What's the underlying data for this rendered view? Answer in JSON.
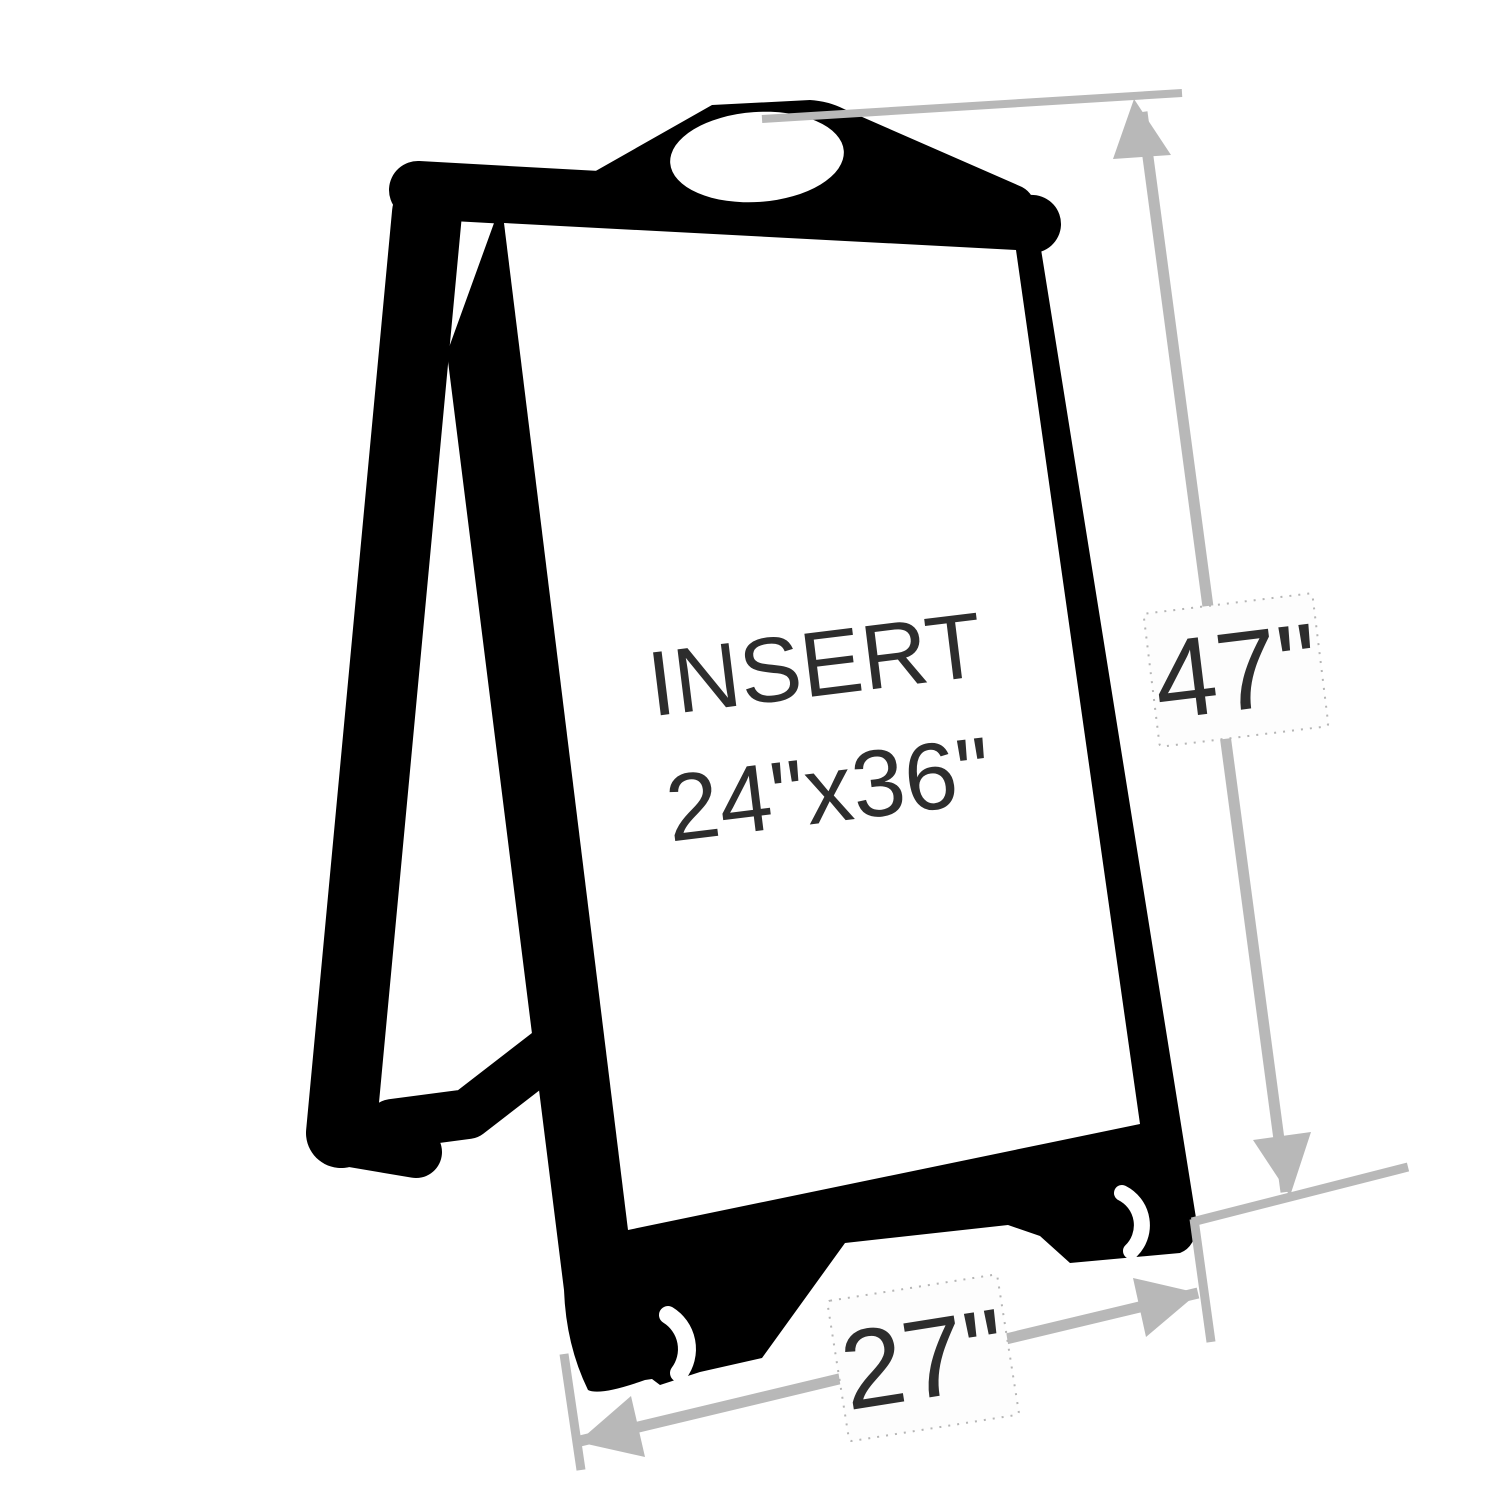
{
  "diagram": {
    "kind": "product-dimension-diagram",
    "subject": "A-frame rolling sidewalk sign silhouette with dimension callouts",
    "insert_label": {
      "line1": "INSERT",
      "line2": "24\"x36\""
    },
    "dimensions": {
      "height_label": "47\"",
      "width_label": "27\""
    }
  },
  "colors": {
    "background": "#ffffff",
    "silhouette": "#000000",
    "dimension_gray": "#b8b8b8",
    "label_text": "#2d2d2d",
    "card_border": "#b5b5b5",
    "card_fill": "#fdfdfd"
  }
}
